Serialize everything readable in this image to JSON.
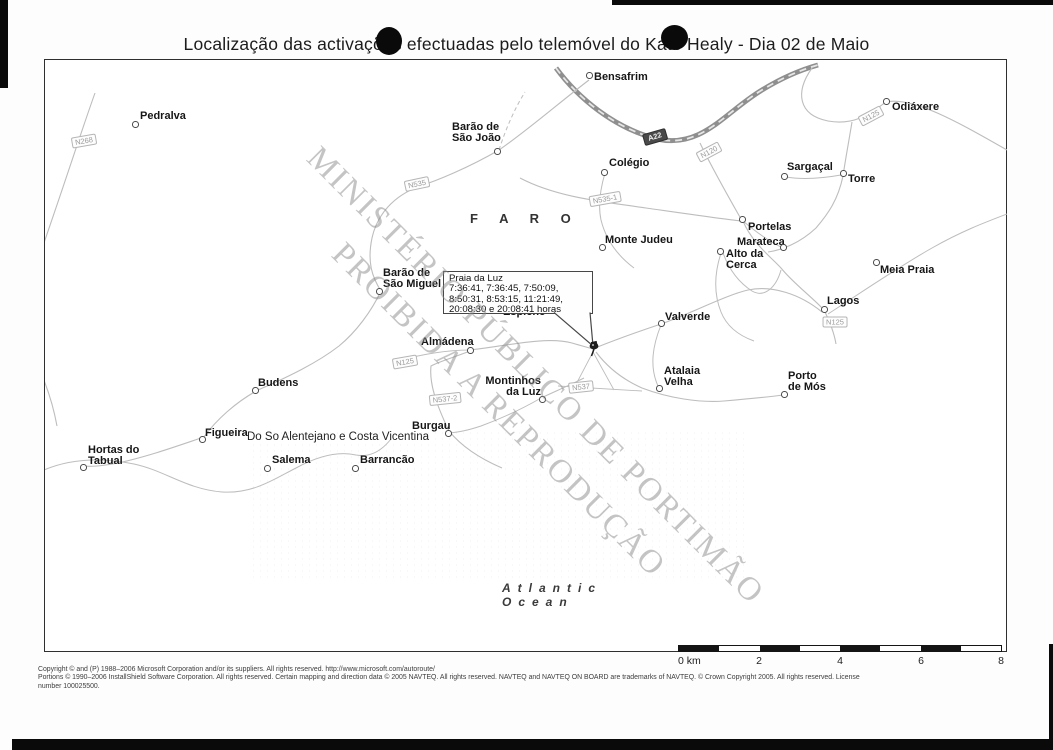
{
  "title": "Localização das activações efectuadas pelo telemóvel do Kate Healy - Dia 02 de Maio",
  "watermark": {
    "line1": "MINISTÉRIO PÚBLICO DE PORTIMÃO",
    "line2": "PROIBIDA A REPRODUÇÃO"
  },
  "callout": {
    "title": "Praia da Luz",
    "times": [
      "7:36:41, 7:36:45, 7:50:09,",
      "8:50:31, 8:53:15, 11:21:49,",
      "20:08:30 e 20:08:41 horas"
    ]
  },
  "map": {
    "region_label": "F A R O",
    "park_label": "Do So Alentejano e Costa Vicentina",
    "ocean_label_line1": "Atlantic",
    "ocean_label_line2": "Ocean",
    "partially_hidden_label": "Espiche",
    "places": [
      {
        "name": "Pedralva",
        "lines": [
          "Pedralva"
        ],
        "x": 140,
        "y": 111,
        "mx": 135,
        "my": 124
      },
      {
        "name": "Barão de São João",
        "lines": [
          "Barão de",
          "São João"
        ],
        "x": 452,
        "y": 122,
        "mx": 497,
        "my": 151
      },
      {
        "name": "Bensafrim",
        "lines": [
          "Bensafrim"
        ],
        "x": 594,
        "y": 72,
        "mx": 589,
        "my": 75
      },
      {
        "name": "Odiáxere",
        "lines": [
          "Odiáxere"
        ],
        "x": 892,
        "y": 102,
        "mx": 886,
        "my": 101
      },
      {
        "name": "Colégio",
        "lines": [
          "Colégio"
        ],
        "x": 609,
        "y": 158,
        "mx": 604,
        "my": 172
      },
      {
        "name": "Sargaçal",
        "lines": [
          "Sargaçal"
        ],
        "x": 787,
        "y": 162,
        "mx": 784,
        "my": 176
      },
      {
        "name": "Torre",
        "lines": [
          "Torre"
        ],
        "x": 848,
        "y": 174,
        "mx": 843,
        "my": 173
      },
      {
        "name": "Portelas",
        "lines": [
          "Portelas"
        ],
        "x": 748,
        "y": 222,
        "mx": 742,
        "my": 219
      },
      {
        "name": "Marateca",
        "lines": [
          "Marateca"
        ],
        "x": 737,
        "y": 237,
        "mx": 783,
        "my": 247
      },
      {
        "name": "Alto da Cerca",
        "lines": [
          "Alto da",
          "Cerca"
        ],
        "x": 726,
        "y": 249,
        "mx": 720,
        "my": 251
      },
      {
        "name": "Meia Praia",
        "lines": [
          "Meia Praia"
        ],
        "x": 880,
        "y": 265,
        "mx": 876,
        "my": 262
      },
      {
        "name": "Monte Judeu",
        "lines": [
          "Monte Judeu"
        ],
        "x": 605,
        "y": 235,
        "mx": 602,
        "my": 247
      },
      {
        "name": "Barão de São Miguel",
        "lines": [
          "Barão de",
          "São Miguel"
        ],
        "x": 383,
        "y": 268,
        "mx": 379,
        "my": 291
      },
      {
        "name": "Lagos",
        "lines": [
          "Lagos"
        ],
        "x": 827,
        "y": 296,
        "mx": 824,
        "my": 309
      },
      {
        "name": "Valverde",
        "lines": [
          "Valverde"
        ],
        "x": 665,
        "y": 312,
        "mx": 661,
        "my": 323
      },
      {
        "name": "Almádena",
        "lines": [
          "Almádena"
        ],
        "x": 421,
        "y": 337,
        "mx": 470,
        "my": 350
      },
      {
        "name": "Atalaia Velha",
        "lines": [
          "Atalaia",
          "Velha"
        ],
        "x": 664,
        "y": 366,
        "mx": 659,
        "my": 388
      },
      {
        "name": "Porto de Mós",
        "lines": [
          "Porto",
          "de Mós"
        ],
        "x": 788,
        "y": 371,
        "mx": 784,
        "my": 394
      },
      {
        "name": "Budens",
        "lines": [
          "Budens"
        ],
        "x": 258,
        "y": 378,
        "mx": 255,
        "my": 390
      },
      {
        "name": "Montinhos da Luz",
        "lines": [
          "Montinhos",
          "da Luz"
        ],
        "x": 541,
        "y": 376,
        "mx": 542,
        "my": 399,
        "align": "right"
      },
      {
        "name": "Burgau",
        "lines": [
          "Burgau"
        ],
        "x": 412,
        "y": 421,
        "mx": 448,
        "my": 433
      },
      {
        "name": "Figueira",
        "lines": [
          "Figueira"
        ],
        "x": 205,
        "y": 428,
        "mx": 202,
        "my": 439
      },
      {
        "name": "Hortas do Tabual",
        "lines": [
          "Hortas do",
          "Tabual"
        ],
        "x": 88,
        "y": 445,
        "mx": 83,
        "my": 467
      },
      {
        "name": "Salema",
        "lines": [
          "Salema"
        ],
        "x": 272,
        "y": 455,
        "mx": 267,
        "my": 468
      },
      {
        "name": "Barrancão",
        "lines": [
          "Barrancão"
        ],
        "x": 360,
        "y": 455,
        "mx": 355,
        "my": 468
      }
    ],
    "road_shields": [
      {
        "text": "N268",
        "x": 84,
        "y": 141,
        "rot": -10
      },
      {
        "text": "N535",
        "x": 417,
        "y": 184,
        "rot": -12
      },
      {
        "text": "N535-1",
        "x": 605,
        "y": 199,
        "rot": -10
      },
      {
        "text": "A22",
        "x": 655,
        "y": 137,
        "rot": -16,
        "motorway": true
      },
      {
        "text": "N120",
        "x": 709,
        "y": 152,
        "rot": -28
      },
      {
        "text": "N125",
        "x": 871,
        "y": 116,
        "rot": -28
      },
      {
        "text": "N125",
        "x": 835,
        "y": 322,
        "rot": 0
      },
      {
        "text": "N125",
        "x": 405,
        "y": 362,
        "rot": -10
      },
      {
        "text": "N537",
        "x": 581,
        "y": 387,
        "rot": -6
      },
      {
        "text": "N537-2",
        "x": 445,
        "y": 399,
        "rot": -6
      }
    ]
  },
  "scale_bar": {
    "unit_label": "0 km",
    "tick_labels": [
      "2",
      "4",
      "6",
      "8"
    ]
  },
  "copyright": {
    "lines": [
      "Copyright © and (P) 1988–2006 Microsoft Corporation and/or its suppliers. All rights reserved. http://www.microsoft.com/autoroute/",
      "Portions © 1990–2006 InstallShield Software Corporation. All rights reserved. Certain mapping and direction data © 2005 NAVTEQ. All rights reserved. NAVTEQ and NAVTEQ ON BOARD are trademarks of NAVTEQ. © Crown Copyright 2005. All rights reserved. License",
      "number 100025500."
    ]
  }
}
